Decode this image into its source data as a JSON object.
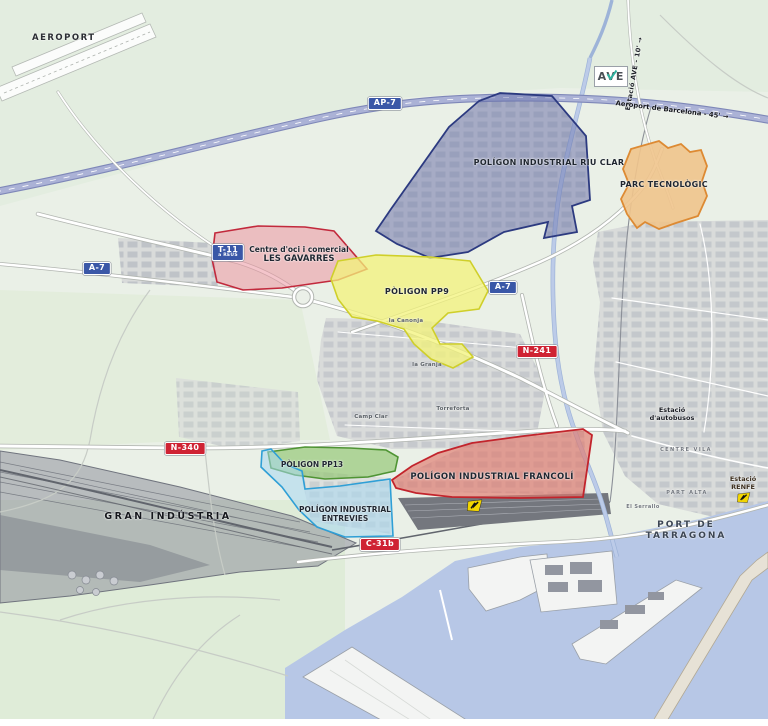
{
  "labels": {
    "aeroport": "AEROPORT",
    "ave": "AVE",
    "estacio_ave": "Estació AVE - 10'  →",
    "aeroport_bcn": "Aeroport de Barcelona - 45'  →",
    "port_1": "PORT DE",
    "port_2": "TARRAGONA",
    "bus_1": "Estació",
    "bus_2": "d'autobusos",
    "renfe_1": "Estació",
    "renfe_2": "RENFE"
  },
  "badges": {
    "ap7": "AP-7",
    "a7_left": "A-7",
    "a7_right": "A-7",
    "t11": "T-11",
    "t11_sub": "a REUS",
    "n241": "N-241",
    "n340": "N-340",
    "c31b": "C-31b"
  },
  "zones": {
    "riu_clar": {
      "label": "POLÍGON INDUSTRIAL RIU CLAR",
      "color": "#2c3a80"
    },
    "parc": {
      "label": "PARC TECNOLÒGIC",
      "color": "#dd8a33"
    },
    "gavarres": {
      "l1": "Centre d'oci i comercial",
      "l2": "LES GAVARRES",
      "color": "#c2293c"
    },
    "pp9": {
      "label": "PÒLIGON PP9",
      "color": "#cfcf2a"
    },
    "pp13": {
      "label": "PÒLIGON PP13",
      "color": "#4f9434"
    },
    "entrevies": {
      "l1": "POLÍGON INDUSTRIAL",
      "l2": "ENTREVIES",
      "color": "#2f9fd6"
    },
    "francoli": {
      "label": "POLÍGON INDUSTRIAL FRANCOLÍ",
      "color": "#c2242c"
    },
    "gran": {
      "label": "GRAN INDÚSTRIA",
      "color": "#70747e"
    }
  },
  "places": {
    "la_canonja": "la Canonja",
    "la_granja": "la Granja",
    "torreforta": "Torreforta",
    "camp_clar": "Camp Clar",
    "centre_vila": "CENTRE VILA",
    "part_alta": "PART ALTA",
    "el_serrallo": "El Serrallo"
  },
  "colors": {
    "land": "#eaf0e7",
    "water": "#b7c7e6",
    "highway": "#abb2d6",
    "badge_blue": "#3a57a7",
    "badge_red": "#cf2233",
    "ave_teal": "#2fb3a0"
  }
}
